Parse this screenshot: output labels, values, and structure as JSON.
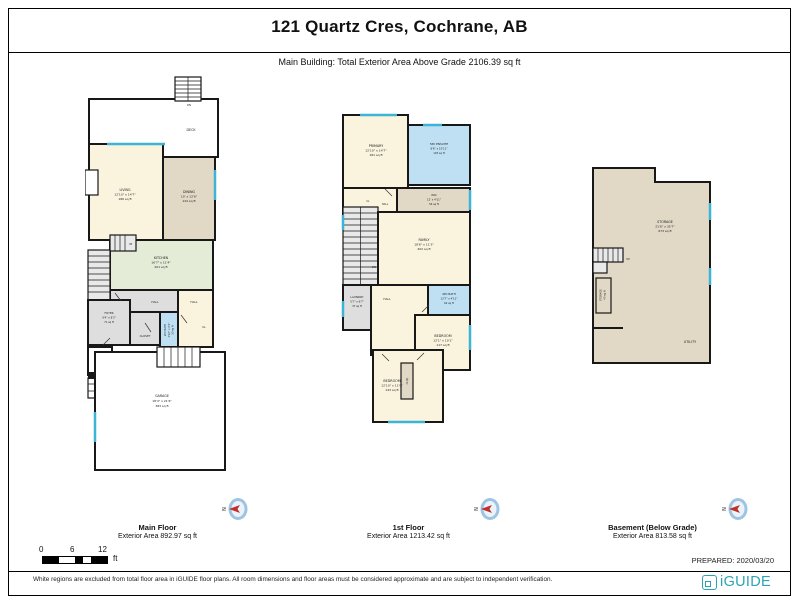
{
  "header": {
    "title": "121 Quartz Cres, Cochrane, AB",
    "subtitle": "Main Building: Total Exterior Area Above Grade 2106.39 sq ft"
  },
  "palette": {
    "wall": "#181818",
    "room_cream": "#FAF4DE",
    "room_tan": "#E1D8C6",
    "room_sage": "#E4EBD6",
    "room_blue": "#BFE0F2",
    "room_gray": "#DEDEDE",
    "excluded_white": "#FFFFFF",
    "window": "#3CB4D6",
    "compass_ring": "#9FC4E2",
    "compass_needle": "#C03028",
    "brand_teal": "#2BA2B5"
  },
  "plans": {
    "main": {
      "label": "Main Floor",
      "area_label": "Exterior Area 892.97 sq ft",
      "rooms": {
        "stairs_top": {
          "n": "DN"
        },
        "deck": {
          "n": "DECK"
        },
        "living": {
          "n": "LIVING",
          "d": "12'10\" x 14'7\"",
          "a": "186 sq ft"
        },
        "dining": {
          "n": "DINING",
          "d": "10' x 12'6\"",
          "a": "124 sq ft"
        },
        "kitchen": {
          "n": "KITCHEN",
          "d": "16'7\" x 11'4\"",
          "a": "201 sq ft"
        },
        "stairs_up": {
          "n": "UP"
        },
        "stairs_dn": {
          "n": "DN"
        },
        "hall_left": {
          "n": "HALL"
        },
        "hall_right": {
          "n": "HALL"
        },
        "foyer": {
          "n": "FOYER",
          "d": "9'4\" x 8'2\"",
          "a": "71 sq ft"
        },
        "closet": {
          "n": "CLOSET"
        },
        "bath2pc": {
          "n": "2PC BATH",
          "d": "4'10\" x 6'1\"",
          "a": "30 sq ft"
        },
        "cl": {
          "n": "CL"
        },
        "porch": {
          "n": "PORCH"
        },
        "garage": {
          "n": "GARAGE",
          "d": "18'4\" x 21'6\"",
          "a": "383 sq ft"
        }
      }
    },
    "first": {
      "label": "1st Floor",
      "area_label": "Exterior Area 1213.42 sq ft",
      "rooms": {
        "primary": {
          "n": "PRIMARY",
          "d": "12'10\" x 14'7\"",
          "a": "181 sq ft"
        },
        "ensuite": {
          "n": "5PC ENSUITE",
          "d": "8'6\" x 10'11\"",
          "a": "103 sq ft"
        },
        "wic": {
          "n": "WIC",
          "d": "12' x 4'11\"",
          "a": "54 sq ft"
        },
        "cl_small": {
          "n": "CL"
        },
        "hall_small": {
          "n": "HALL"
        },
        "stairs_dn": {
          "n": "DN"
        },
        "family": {
          "n": "FAMILY",
          "d": "18'6\" x 11'3\"",
          "a": "202 sq ft"
        },
        "laundry": {
          "n": "LAUNDRY",
          "d": "5'7\" x 6'7\"",
          "a": "37 sq ft"
        },
        "hall": {
          "n": "HALL"
        },
        "bath4pc": {
          "n": "4PC BATH",
          "d": "12'7\" x 4'11\"",
          "a": "62 sq ft"
        },
        "bedroom_right": {
          "n": "BEDROOM",
          "d": "12'1\" x 10'1\"",
          "a": "117 sq ft"
        },
        "closet_cls": {
          "n": "CL(S)"
        },
        "bedroom_bottom": {
          "n": "BEDROOM",
          "d": "12'10\" x 11'9\"",
          "a": "143 sq ft"
        }
      }
    },
    "basement": {
      "label": "Basement (Below Grade)",
      "area_label": "Exterior Area 813.58 sq ft",
      "rooms": {
        "storage": {
          "n": "STORAGE",
          "d": "21'6\" x 35'7\"",
          "a": "673 sq ft"
        },
        "storage_small": {
          "n": "STORAGE",
          "a": "40 sq ft"
        },
        "utility": {
          "n": "UTILITY"
        },
        "stairs_up": {
          "n": "UP"
        }
      }
    }
  },
  "compass": {
    "label": "N"
  },
  "scale": {
    "zero": "0",
    "six": "6",
    "twelve": "12",
    "unit": "ft"
  },
  "footer": {
    "prepared": "PREPARED: 2020/03/20",
    "disclaimer": "White regions are excluded from total floor area in iGUIDE floor plans. All room dimensions and floor areas must be considered approximate and are subject to independent verification.",
    "logo": "iGUIDE"
  }
}
